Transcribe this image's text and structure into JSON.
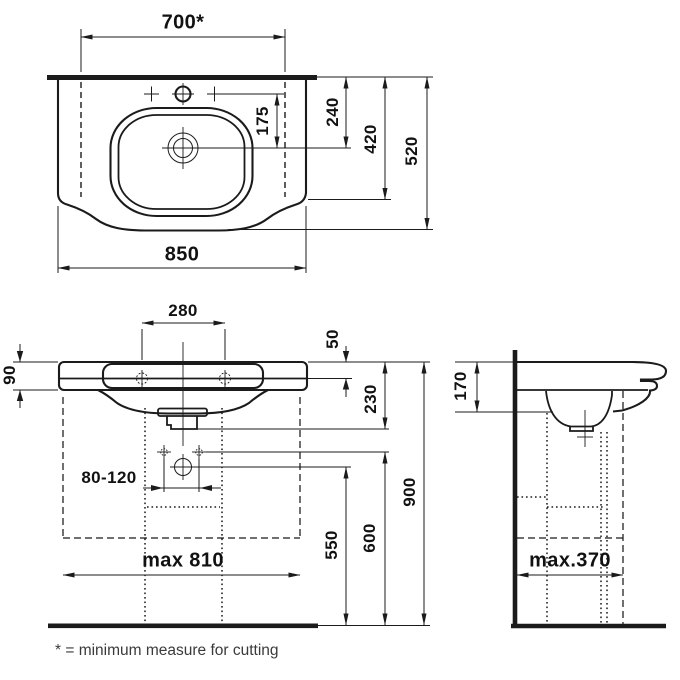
{
  "labels": {
    "cut_width": "700*",
    "total_width": "850",
    "back_to_drain": "240",
    "back_to_front": "420",
    "total_depth": "520",
    "tap_to_drain": "175",
    "bolt_spacing": "280",
    "apron_height": "90",
    "top_to_bolts": "50",
    "top_to_waste": "230",
    "supply_spacing": "80-120",
    "supply_height": "550",
    "bolt_height": "600",
    "rim_height": "900",
    "max_unit_width": "max 810",
    "profile_height": "170",
    "max_unit_depth": "max.370"
  },
  "footnote": "* = minimum measure for cutting",
  "style": {
    "line_color": "#1b1b1b",
    "background": "#ffffff"
  }
}
